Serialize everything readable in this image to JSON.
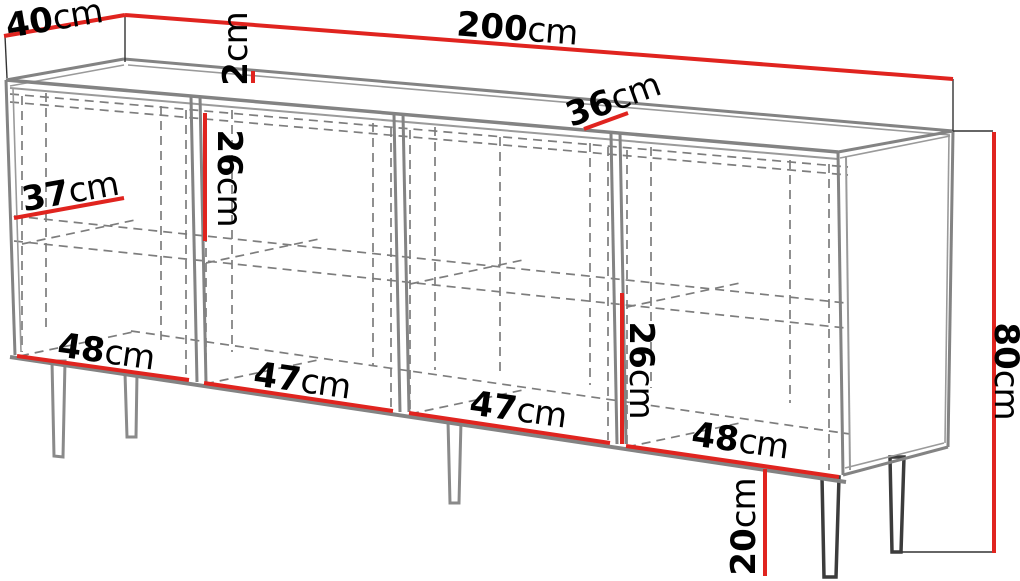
{
  "diagram": {
    "kind": "furniture-dimension-drawing",
    "unit": "cm",
    "colors": {
      "dimension_line": "#e0241f",
      "structure_line": "#838383",
      "dashed_line": "#7d7d7d",
      "extension_line": "#333333",
      "label_text": "#000000",
      "background": "#ffffff"
    },
    "dimensions": {
      "total_depth": {
        "value": "40",
        "unit": "cm"
      },
      "total_width": {
        "value": "200",
        "unit": "cm"
      },
      "top_panel_thickness": {
        "value": "2",
        "unit": "cm"
      },
      "top_interior_depth": {
        "value": "36",
        "unit": "cm"
      },
      "shelf_depth": {
        "value": "37",
        "unit": "cm"
      },
      "left_shelf_spacing": {
        "value": "26",
        "unit": "cm"
      },
      "right_shelf_spacing": {
        "value": "26",
        "unit": "cm"
      },
      "compartment_1_width": {
        "value": "48",
        "unit": "cm"
      },
      "compartment_2_width": {
        "value": "47",
        "unit": "cm"
      },
      "compartment_3_width": {
        "value": "47",
        "unit": "cm"
      },
      "compartment_4_width": {
        "value": "48",
        "unit": "cm"
      },
      "total_height": {
        "value": "80",
        "unit": "cm"
      },
      "leg_height": {
        "value": "20",
        "unit": "cm"
      }
    }
  }
}
